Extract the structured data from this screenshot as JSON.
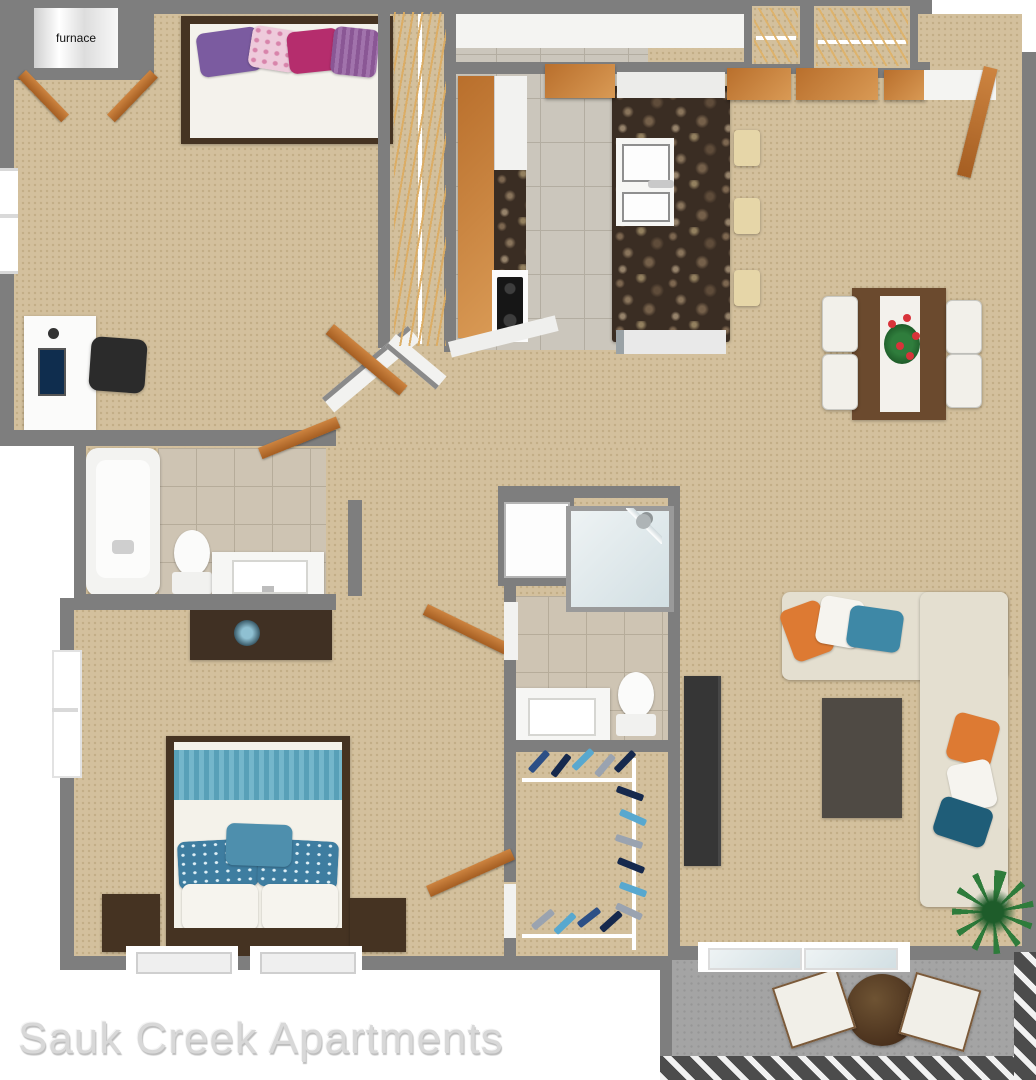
{
  "watermark": {
    "text": "Sauk Creek Apartments"
  },
  "labels": {
    "furnace": "furnace"
  },
  "scene": {
    "type": "3d-top-down-apartment-floor-plan",
    "bedrooms_visible": 2,
    "bathrooms_visible": 2,
    "balcony_visible": true
  },
  "palette": {
    "wall_gray": "#7e7e7e",
    "carpet_tan": "#d3c09d",
    "bath_tile": "#cec4b3",
    "kitchen_tile": "#cbc6bc",
    "door_wood": "#c07a36",
    "dark_wood": "#453322",
    "granite_brown": "#3a2d23",
    "sofa_cream": "#e4dfd0",
    "accent_orange": "#dd7a33",
    "accent_teal": "#4e8fad",
    "accent_dark_teal": "#1f5d78",
    "pillow_purple": "#7b5ba0",
    "pillow_magenta": "#b52d6d",
    "pillow_pink": "#eecadb",
    "patio_concrete": "#a4a4a4",
    "plant_green": "#2e7c3b",
    "watermark_gray": "#d8d8d8"
  },
  "furniture_icons": [
    "furnace",
    "bed",
    "desk",
    "monitor",
    "office-chair",
    "walk-in-closet-rod",
    "clothes-hangers",
    "refrigerator-counter",
    "range-cooktop",
    "kitchen-island",
    "island-sink",
    "dishwasher",
    "bar-stools",
    "dining-table",
    "dining-chairs",
    "flower-centerpiece",
    "bathtub",
    "toilet",
    "vanity-sink",
    "dresser",
    "shower-stall",
    "washer",
    "sectional-sofa",
    "throw-pillows",
    "coffee-table",
    "tv-console",
    "nightstand",
    "window",
    "sliding-glass-door",
    "patio-table",
    "patio-chairs",
    "potted-plant",
    "balcony-railing"
  ]
}
